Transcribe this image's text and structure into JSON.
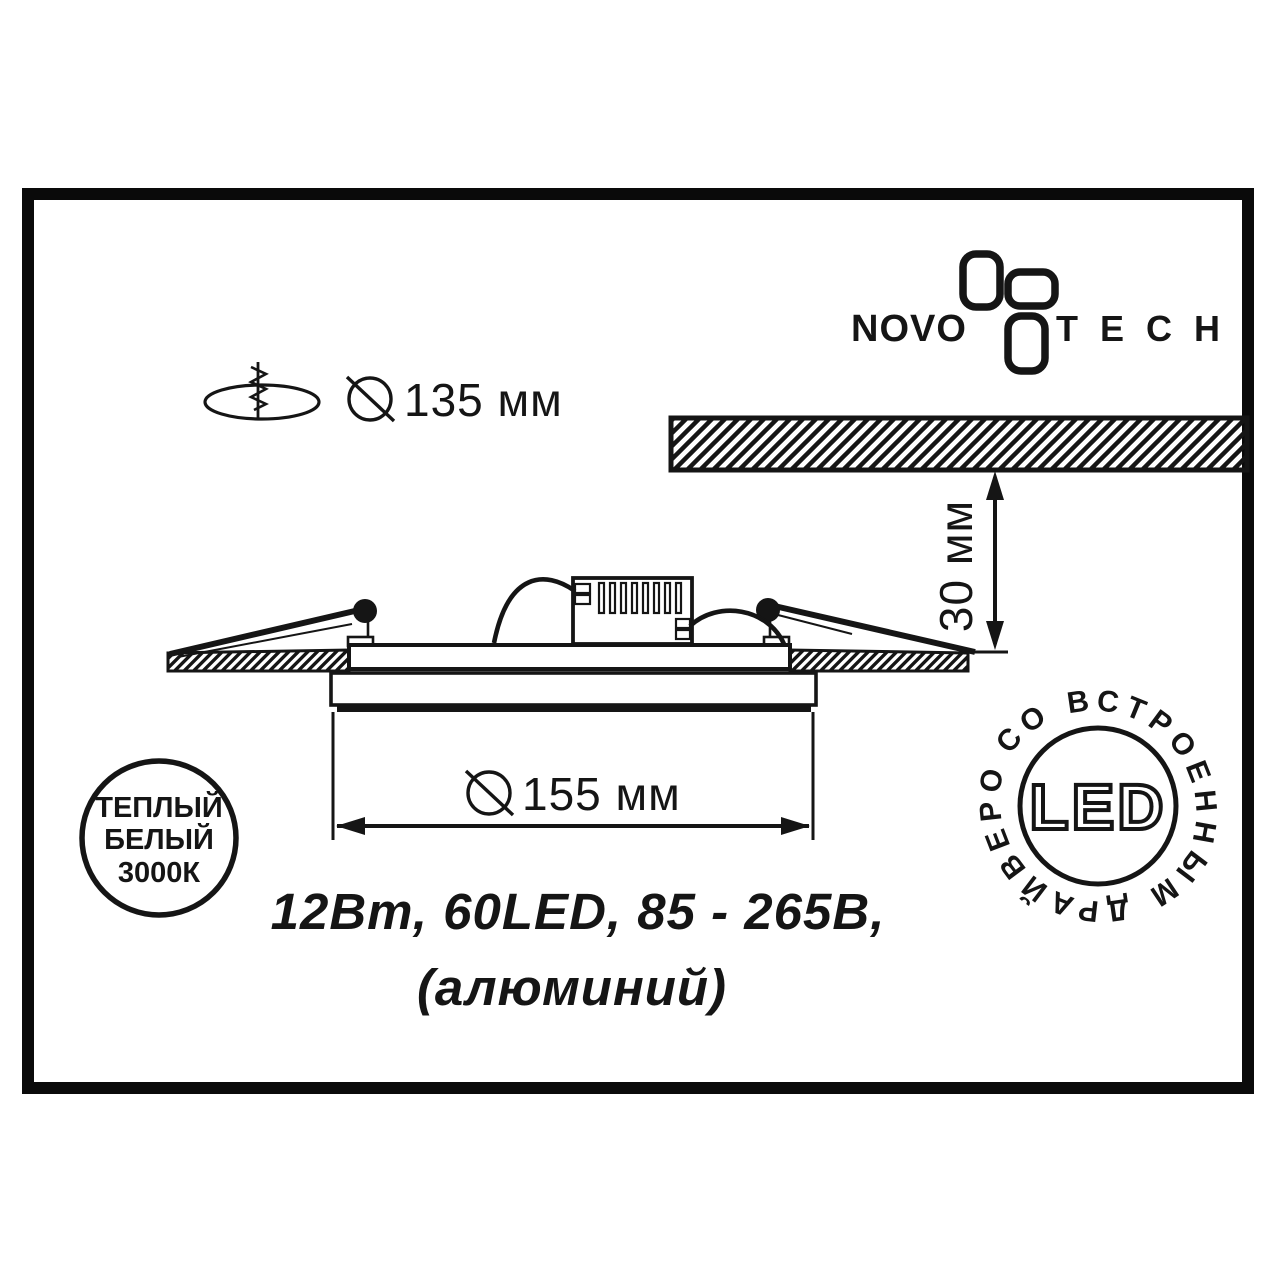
{
  "page": {
    "background": "#ffffff",
    "ink": "#151515"
  },
  "brand": {
    "name_left": "NOVO",
    "name_right": "TECH",
    "flower_icon": "novotech-flower-icon"
  },
  "cutout_dimension": {
    "icon": "ceiling-cutout-icon",
    "diameter_icon": "diameter-symbol-icon",
    "label": "135 мм"
  },
  "recess_dimension": {
    "label": "30 мм"
  },
  "body_dimension": {
    "diameter_icon": "diameter-symbol-icon",
    "label": "155 мм"
  },
  "specs": {
    "line1": "12Вт, 60LED, 85 - 265В,",
    "line2": "(алюминий)"
  },
  "warm_white_badge": {
    "line1": "ТЕПЛЫЙ",
    "line2": "БЕЛЫЙ",
    "line3": "3000К"
  },
  "led_badge": {
    "label": "LED",
    "ring_text": "СО ВСТРОЕННЫМ ДРАЙВЕРОМ"
  }
}
